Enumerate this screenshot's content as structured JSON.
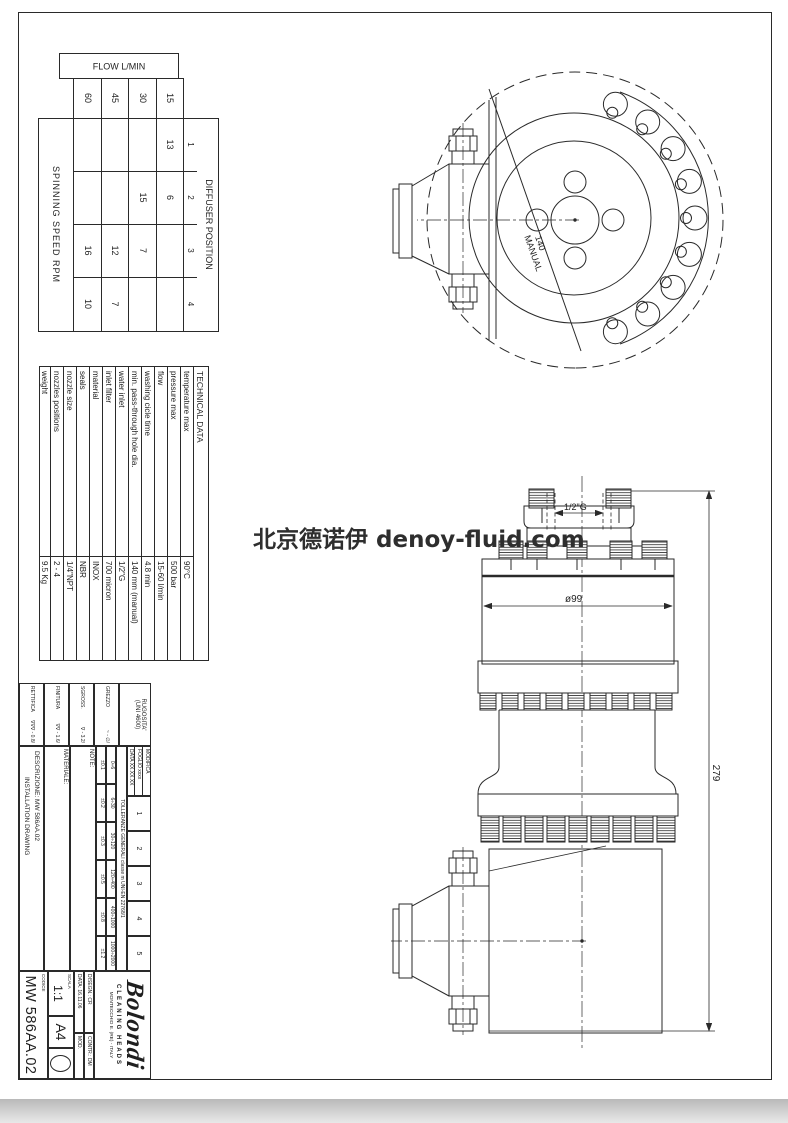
{
  "watermark": {
    "text": "北京德诺伊 denoy-fluid.com"
  },
  "flow_table": {
    "header": "FLOW L/MIN",
    "diffuser_header": "DIFFUSER POSITION",
    "positions": [
      "1",
      "2",
      "3",
      "4"
    ],
    "spinning_label": "SPINNING SPEED RPM",
    "rows": [
      {
        "flow": "15",
        "rpm": [
          "13",
          "6",
          "",
          ""
        ]
      },
      {
        "flow": "30",
        "rpm": [
          "",
          "15",
          "7",
          ""
        ]
      },
      {
        "flow": "45",
        "rpm": [
          "",
          "",
          "12",
          "7"
        ]
      },
      {
        "flow": "60",
        "rpm": [
          "",
          "",
          "16",
          "10"
        ]
      }
    ]
  },
  "technical_data": {
    "title": "TECHNICAL DATA",
    "rows": [
      {
        "label": "temperature max",
        "value": "90°C"
      },
      {
        "label": "pressure max",
        "value": "500 bar"
      },
      {
        "label": "flow",
        "value": "15-60 l/min"
      },
      {
        "label": "washing cicle time",
        "value": "4.8 min"
      },
      {
        "label": "min. pass-through hole dia.",
        "value": "140 mm (manual)"
      },
      {
        "label": "water inlet",
        "value": "1/2\"G"
      },
      {
        "label": "inlet filter",
        "value": "700 micron"
      },
      {
        "label": "material",
        "value": "INOX"
      },
      {
        "label": "seals",
        "value": "NBR"
      },
      {
        "label": "nozzle size",
        "value": "1/4\"NPT"
      },
      {
        "label": "nozzles positions",
        "value": "2 - 4"
      },
      {
        "label": "weight",
        "value": "9.5 Kg"
      }
    ]
  },
  "title_block": {
    "surface": {
      "rugosita": "RUGOSITA'",
      "rugosita_sub": "(UNI 4600)",
      "grezzo": "GREZZO",
      "grezzo_val": "~ - ∅/",
      "sgross": "SGROSS.",
      "sgross_val": "∇ - 3.2/",
      "finitura": "FINITURA",
      "finitura_val": "∇∇ - 1.6/",
      "rettifica": "RETTIFICA",
      "rettifica_val": "∇∇∇ - 0.8/"
    },
    "modifica": {
      "label": "MODIFICA",
      "foglio": "FOGLIO xxxx",
      "data": "DATA XX.XX.XX",
      "cols": [
        "1",
        "2",
        "3",
        "4",
        "5"
      ]
    },
    "tolleranze": {
      "header": "TOLLERANZE GENERALI classe m UNI-EN 22768/1",
      "ranges": [
        "0÷6",
        "6÷30",
        "30÷120",
        "120÷400",
        "400÷1000",
        "1000÷2000"
      ],
      "values": [
        "±0.1",
        "±0.2",
        "±0.3",
        "±0.5",
        "±0.8",
        "±1.2"
      ]
    },
    "note_label": "NOTE:",
    "materiale_label": "MATERIALE:",
    "descrizione_line1": "DESCRIZIONE: MW 586AA.02",
    "descrizione_line2": "INSTALLATION DRAWING",
    "logo": {
      "name": "Bolondi",
      "tagline": "CLEANING HEADS",
      "address": "MONTECCHIO E. (RE) - ITALY"
    },
    "disegn": "DISEGN.: CR",
    "contr": "CONTR.: DM",
    "data": "DATA: 16.11.06",
    "mod": "MOD.",
    "scala_label": "SCALA",
    "scala": "1:1",
    "formato": "A4",
    "codice_label": "CODICE",
    "codice": "MW 586AA.02"
  },
  "drawing": {
    "dim_279": "279",
    "dim_d99": "ø99",
    "dim_halfg": "1/2\"G",
    "label_140": "140",
    "label_manual": "MANUAL"
  }
}
